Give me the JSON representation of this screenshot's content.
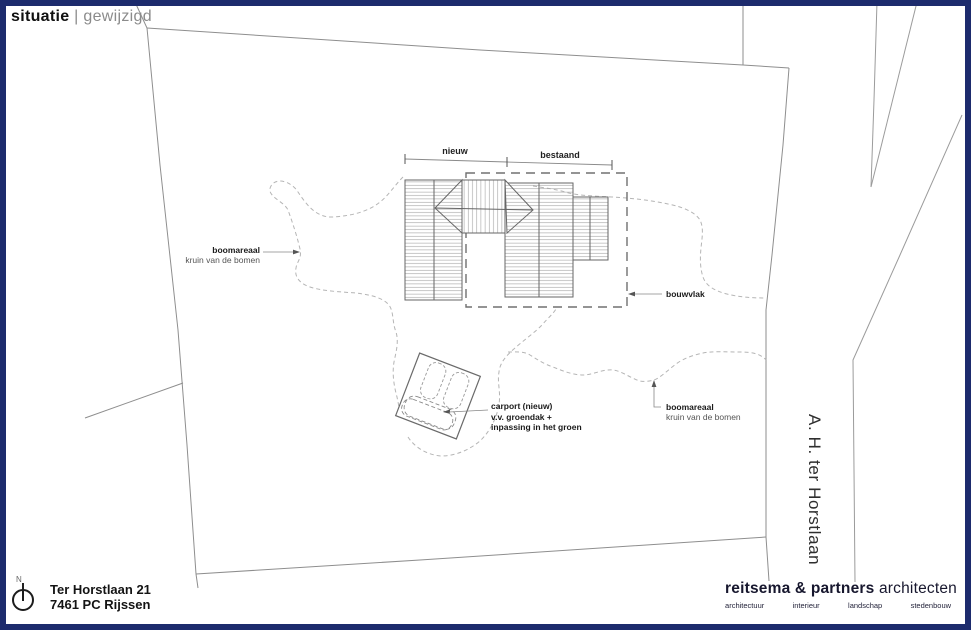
{
  "title": {
    "primary": "situatie",
    "separator": "|",
    "secondary": "gewijzigd"
  },
  "plan": {
    "dimensions": {
      "left_label": "nieuw",
      "right_label": "bestaand"
    },
    "labels": {
      "tree_area_left": {
        "line1": "boomareaal",
        "line2": "kruin van de bomen"
      },
      "tree_area_right": {
        "line1": "boomareaal",
        "line2": "kruin van de bomen"
      },
      "building_zone": "bouwvlak",
      "carport": {
        "line1": "carport (nieuw)",
        "line2": "v.v. groendak +",
        "line3": "inpassing in het groen"
      }
    },
    "street_name": "A. H. ter Horstlaan",
    "north_label": "N"
  },
  "footer": {
    "address": {
      "line1": "Ter Horstlaan 21",
      "line2": "7461 PC Rijssen"
    },
    "firm": {
      "bold": "reitsema & partners",
      "regular": "architecten",
      "disciplines": [
        "architectuur",
        "interieur",
        "landschap",
        "stedenbouw"
      ]
    }
  },
  "colors": {
    "frame_navy": "#1d2b6d",
    "parcel_line": "#8e8e8e",
    "building_outline": "#666666",
    "hatch": "#a2a2a2",
    "building_zone_dash": "#707070",
    "tree_dash": "#b5b5b5",
    "label_text": "#1a1a1a"
  }
}
